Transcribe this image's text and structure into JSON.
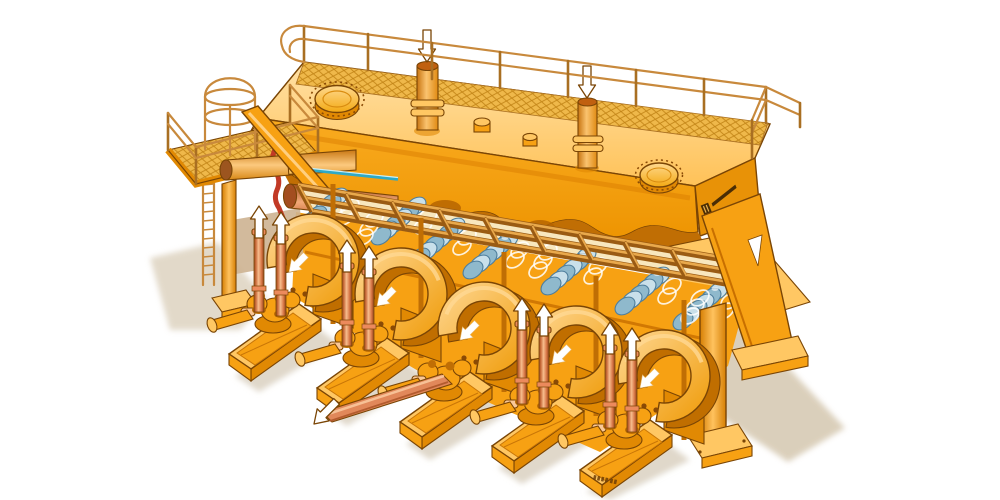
{
  "title": "Cutaway technical illustration of a five-cylinder industrial piston pump installation",
  "canvas": {
    "width": 1000,
    "height": 500,
    "background": "#FFFFFF"
  },
  "palette": {
    "c-white": "#FFFFFF",
    "c-main": "#F7A113",
    "c-light": "#FFC763",
    "c-lighter": "#FFE0A4",
    "c-dark": "#E18903",
    "c-deep": "#C06E04",
    "c-cream": "#F8E7BE",
    "c-outline": "#7A4505",
    "c-outline2": "#593201",
    "c-red": "#C23A26",
    "c-salmon": "#EC8A5C",
    "c-salmon-d": "#A85026",
    "c-salmon-l": "#FAC897",
    "c-blue-l": "#C9E0EA",
    "c-blue": "#8FB9CC",
    "c-blue-d": "#4E7E9C",
    "c-teal": "#2FA9C6",
    "c-mesh": "#EFB84A",
    "c-mesh-line": "#C28416",
    "c-rail": "#C8893C",
    "c-rail-d": "#A96F22",
    "c-shadow": "#D9CDB8",
    "c-shadow-soft": "#E0D8CA",
    "c-tan": "#CDB391"
  },
  "scene": {
    "background": "plain white, no text labels",
    "access_platform": {
      "grating": "diamond-mesh",
      "handrails": true,
      "ladder_cage_hoops": 3,
      "caged_ladder": true,
      "support_column_base_plates": 1
    },
    "header_tank": {
      "manhole_covers": 2,
      "inlet_pipes": 2,
      "inlet_flow_arrows_down": 2,
      "pipe_flange_rings_per_pipe": 2,
      "deck_grating_walkway": true,
      "handrail_posts_back": 8,
      "small_deck_stubs": 2,
      "end_face_logo_plate": {
        "present": true,
        "legible": false
      }
    },
    "cutaway": {
      "red_cut_edge": true,
      "horizontal_hydraulic_cylinders": 2,
      "piston_rod_color": "teal"
    },
    "valve_lattice": {
      "long_rails": 3,
      "crossbars": 11,
      "blue_diaphragm_clusters": 7,
      "white_coil_springs": 3
    },
    "pump_units": {
      "count": 5,
      "units_with_vertical_cylinder_pairs": [
        1,
        2,
        4,
        5
      ],
      "vertical_cylinder_up_arrows": 8,
      "arch_flow_arrows_down_left": 5,
      "unit_with_discharge_pipe": 3,
      "discharge_flow_arrow_down_left": 1,
      "suction_stub_flanges": 4,
      "serial_stamp": {
        "on_unit": 5,
        "legible": false
      }
    },
    "supports": {
      "right_a_frame_leg": true,
      "right_front_column": 1,
      "base_plates": 4
    },
    "ground_shadows": {
      "left_patch": 1,
      "under_units": 5,
      "large_right": 1
    }
  }
}
